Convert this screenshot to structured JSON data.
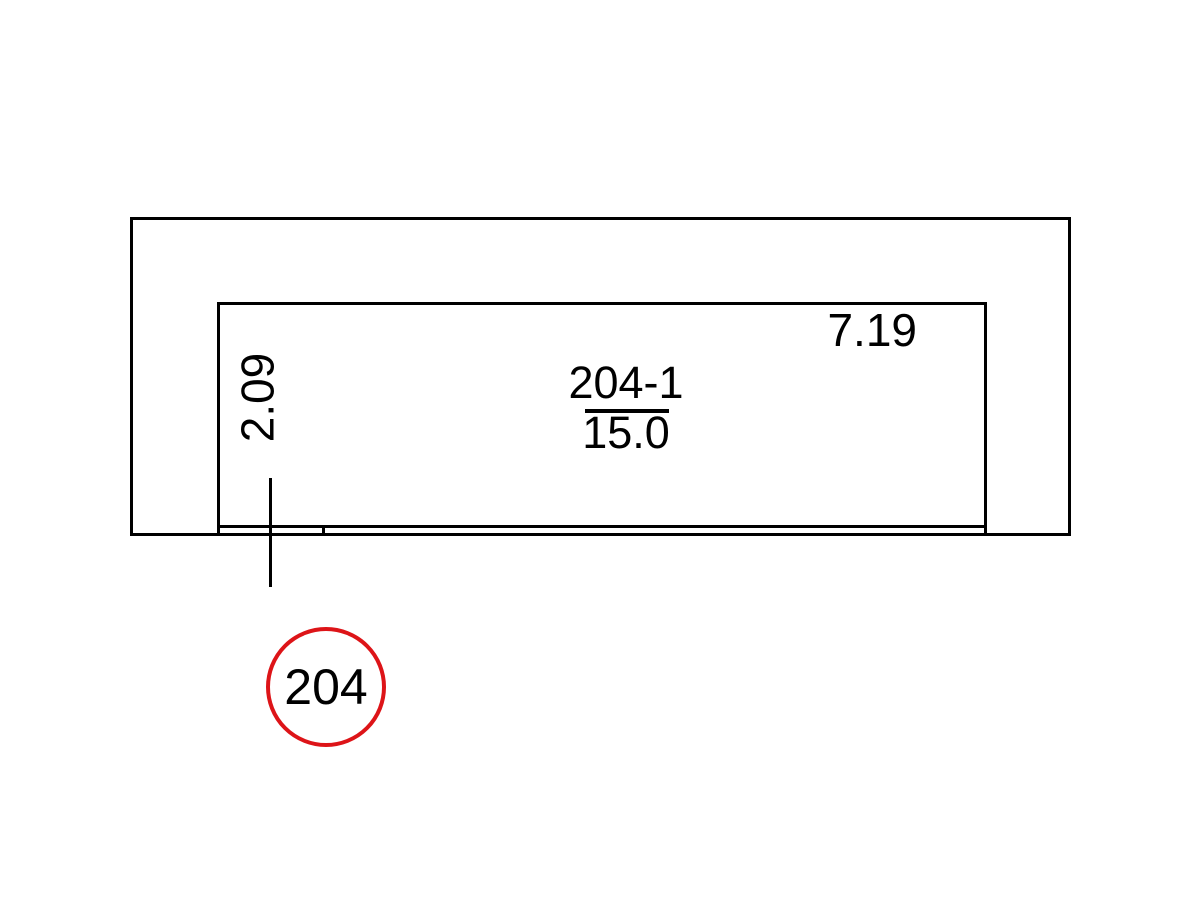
{
  "drawing": {
    "room_id": "204-1",
    "room_area": "15.0",
    "width_dim": "7.19",
    "depth_dim": "2.09",
    "room_number": "204"
  },
  "colors": {
    "line": "#000000",
    "text": "#000000",
    "bubble_stroke": "#dd1418",
    "background": "#ffffff"
  }
}
